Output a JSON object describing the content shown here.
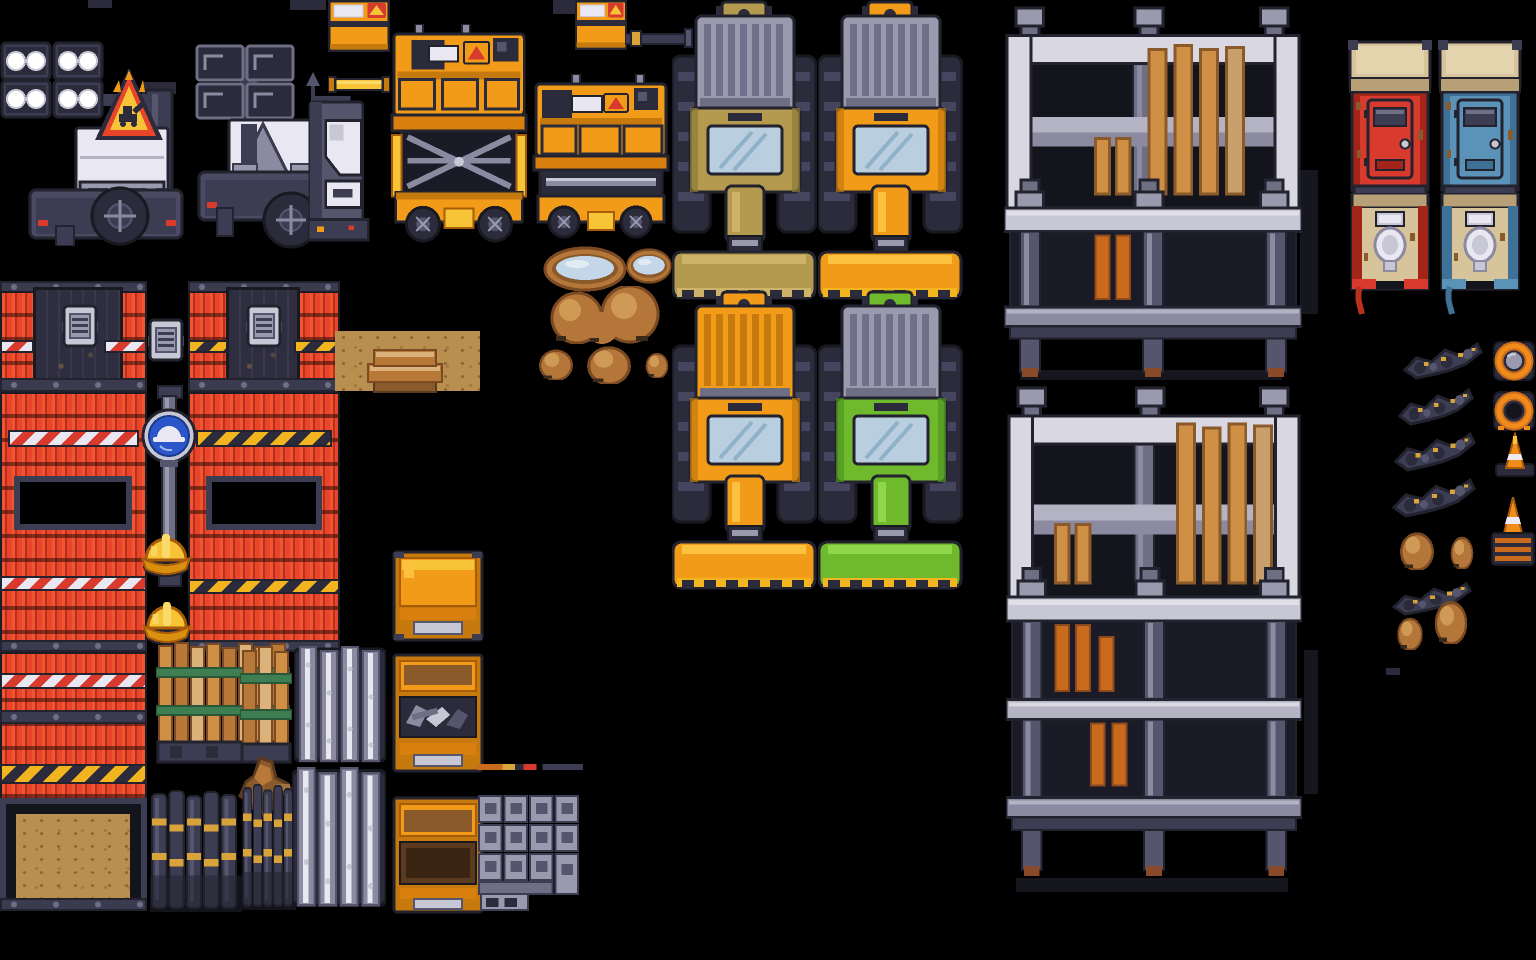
{
  "meta": {
    "asset_label": "construction-site pixel-art tileset spritesheet",
    "canvas": {
      "width": 1536,
      "height": 960,
      "background": "#000000"
    }
  },
  "palette": {
    "background": "#000000",
    "outline": "#23232f",
    "dark_navy": "#2b2b3b",
    "steel_dark": "#3c3c52",
    "steel_mid": "#55556e",
    "steel": "#6e6e85",
    "gray": "#9a9aae",
    "gray_light": "#c7c7d6",
    "white": "#e9e8f2",
    "scaffold_light": "#d8d7e2",
    "scaffold_mid": "#b4b3c4",
    "scaffold_shade": "#8b8aa0",
    "red_wall": "#e8452a",
    "red_wall_dark": "#b92f1f",
    "red_toilet": "#d93a2e",
    "blue_toilet": "#5b93b8",
    "blue_sign": "#2b56c9",
    "orange": "#f29b18",
    "orange_deep": "#c67a0d",
    "gold": "#f7c337",
    "gold_pale": "#fada6a",
    "hazard_yellow": "#f2b51f",
    "tan_vehicle": "#b39a4f",
    "green_vehicle": "#6fba2c",
    "wood": "#cf8f45",
    "wood_dark": "#8a5a2b",
    "dirt": "#b98f4f",
    "mound": "#b5763a",
    "water": "#c3d7e8",
    "cone_orange": "#f08c1c",
    "strap_green": "#3f7d52",
    "windshield": "#b9cede",
    "roof_tan": "#d8c49a"
  },
  "sprites": [
    {
      "name": "light-tower-lights-on",
      "type": "light-tower-on",
      "x": 0,
      "y": 38,
      "w": 185,
      "h": 208
    },
    {
      "name": "warning-triangle-sign",
      "type": "warning-triangle",
      "x": 93,
      "y": 66,
      "w": 72,
      "h": 80
    },
    {
      "name": "light-tower-lights-off",
      "type": "light-tower-off",
      "x": 195,
      "y": 40,
      "w": 152,
      "h": 210
    },
    {
      "name": "edge-stub",
      "type": "stub",
      "x": 88,
      "y": 0,
      "w": 24,
      "h": 8
    },
    {
      "name": "edge-stub",
      "type": "stub",
      "x": 290,
      "y": 0,
      "w": 36,
      "h": 10
    },
    {
      "name": "generator-box",
      "type": "generator",
      "x": 328,
      "y": 0,
      "w": 62,
      "h": 52
    },
    {
      "name": "gold-beam",
      "type": "beam-h",
      "x": 328,
      "y": 76,
      "w": 62,
      "h": 17
    },
    {
      "name": "white-compressor",
      "type": "compressor",
      "x": 308,
      "y": 96,
      "w": 62,
      "h": 150
    },
    {
      "name": "scissor-lift-extended",
      "type": "scissor-ext",
      "x": 388,
      "y": 24,
      "w": 144,
      "h": 220
    },
    {
      "name": "edge-stub",
      "type": "stub",
      "x": 553,
      "y": 0,
      "w": 34,
      "h": 14
    },
    {
      "name": "generator-box",
      "type": "generator",
      "x": 575,
      "y": 0,
      "w": 52,
      "h": 50
    },
    {
      "name": "exhaust-pipe-arm",
      "type": "pipe-arm",
      "x": 625,
      "y": 28,
      "w": 68,
      "h": 20
    },
    {
      "name": "scissor-lift-lowered",
      "type": "scissor-low",
      "x": 532,
      "y": 74,
      "w": 138,
      "h": 170
    },
    {
      "name": "bulldozer-tan",
      "type": "dozer",
      "x": 672,
      "y": 0,
      "w": 145,
      "h": 300,
      "colors": {
        "hitch": "#b39a4f",
        "grille": "#9a9aae",
        "grille-rib": "#70708a",
        "body": "#b39a4f",
        "body-dk": "#8f7a39",
        "body-lt": "#cdb469",
        "blade": "#b39a4f",
        "blade-lt": "#cdb469",
        "tooth": "#cdb469"
      }
    },
    {
      "name": "bulldozer-orange",
      "type": "dozer",
      "x": 818,
      "y": 0,
      "w": 145,
      "h": 300,
      "colors": {
        "hitch": "#f29b18",
        "grille": "#9a9aae",
        "grille-rib": "#70708a",
        "body": "#f29b18",
        "body-dk": "#c67a0d",
        "body-lt": "#fbc13f",
        "blade": "#f29b18",
        "blade-lt": "#fbc13f",
        "tooth": "#f2b51f"
      }
    },
    {
      "name": "bulldozer-orange-full",
      "type": "dozer",
      "x": 672,
      "y": 290,
      "w": 145,
      "h": 300,
      "colors": {
        "hitch": "#f29b18",
        "grille": "#f29b18",
        "grille-rib": "#c67a0d",
        "body": "#f29b18",
        "body-dk": "#c67a0d",
        "body-lt": "#fbc13f",
        "blade": "#f29b18",
        "blade-lt": "#fbc13f",
        "tooth": "#f2b51f"
      }
    },
    {
      "name": "bulldozer-green",
      "type": "dozer",
      "x": 818,
      "y": 290,
      "w": 145,
      "h": 300,
      "colors": {
        "hitch": "#6fba2c",
        "grille": "#9a9aae",
        "grille-rib": "#70708a",
        "body": "#6fba2c",
        "body-dk": "#4e9420",
        "body-lt": "#8fd64a",
        "blade": "#6fba2c",
        "blade-lt": "#8fd64a",
        "tooth": "#f2b51f"
      }
    },
    {
      "name": "scaffold-shadow",
      "type": "shadow",
      "x": 1300,
      "y": 170,
      "w": 18,
      "h": 144
    },
    {
      "name": "scaffold-shadow",
      "type": "shadow",
      "x": 1020,
      "y": 370,
      "w": 262,
      "h": 10
    },
    {
      "name": "scaffold-two-level",
      "type": "scaffold-a",
      "x": 1004,
      "y": 6,
      "w": 298,
      "h": 372
    },
    {
      "name": "scaffold-shadow",
      "type": "shadow",
      "x": 1304,
      "y": 650,
      "w": 14,
      "h": 144
    },
    {
      "name": "scaffold-shadow",
      "type": "shadow",
      "x": 1016,
      "y": 878,
      "w": 272,
      "h": 14
    },
    {
      "name": "scaffold-three-level",
      "type": "scaffold-b",
      "x": 1006,
      "y": 386,
      "w": 296,
      "h": 497
    },
    {
      "name": "porta-potty-red-closed",
      "type": "toilet-closed",
      "x": 1348,
      "y": 40,
      "w": 84,
      "h": 162,
      "colors": {
        "shell": "#d93a2e",
        "shell-dk": "#a32419"
      }
    },
    {
      "name": "porta-potty-blue-closed",
      "type": "toilet-closed",
      "x": 1438,
      "y": 40,
      "w": 84,
      "h": 162,
      "colors": {
        "shell": "#5b93b8",
        "shell-dk": "#3f7095"
      }
    },
    {
      "name": "porta-potty-red-open",
      "type": "toilet-open",
      "x": 1350,
      "y": 193,
      "w": 80,
      "h": 122,
      "colors": {
        "shell": "#d93a2e",
        "shell-dk": "#a32419",
        "hose": "#b92f1f"
      }
    },
    {
      "name": "porta-potty-blue-open",
      "type": "toilet-open",
      "x": 1440,
      "y": 193,
      "w": 80,
      "h": 122,
      "colors": {
        "shell": "#5b93b8",
        "shell-dk": "#3f7095",
        "hose": "#3f7095"
      }
    },
    {
      "name": "water-puddle-large",
      "type": "puddle",
      "x": 543,
      "y": 246,
      "w": 84,
      "h": 46
    },
    {
      "name": "water-puddle-small",
      "type": "puddle",
      "x": 626,
      "y": 248,
      "w": 46,
      "h": 36
    },
    {
      "name": "dirt-mound-pair",
      "type": "mound-pair",
      "x": 532,
      "y": 286,
      "w": 142,
      "h": 58
    },
    {
      "name": "dirt-mound",
      "type": "mound",
      "x": 532,
      "y": 346,
      "w": 48,
      "h": 34
    },
    {
      "name": "dirt-mound",
      "type": "mound",
      "x": 578,
      "y": 342,
      "w": 62,
      "h": 42
    },
    {
      "name": "dirt-mound",
      "type": "mound",
      "x": 641,
      "y": 350,
      "w": 32,
      "h": 28
    },
    {
      "name": "rubble-streak",
      "type": "debris",
      "x": 1403,
      "y": 340,
      "w": 80,
      "h": 40
    },
    {
      "name": "rubble-streak",
      "type": "debris",
      "x": 1398,
      "y": 386,
      "w": 76,
      "h": 40
    },
    {
      "name": "rubble-streak",
      "type": "debris",
      "x": 1394,
      "y": 430,
      "w": 82,
      "h": 42
    },
    {
      "name": "rubble-streak",
      "type": "debris",
      "x": 1392,
      "y": 476,
      "w": 84,
      "h": 42
    },
    {
      "name": "dirt-mound",
      "type": "mound",
      "x": 1393,
      "y": 528,
      "w": 48,
      "h": 42
    },
    {
      "name": "dirt-mound",
      "type": "mound",
      "x": 1446,
      "y": 533,
      "w": 32,
      "h": 36
    },
    {
      "name": "rubble-streak",
      "type": "debris",
      "x": 1392,
      "y": 580,
      "w": 80,
      "h": 36
    },
    {
      "name": "dirt-mound",
      "type": "mound",
      "x": 1428,
      "y": 596,
      "w": 46,
      "h": 48
    },
    {
      "name": "dirt-mound",
      "type": "mound",
      "x": 1392,
      "y": 614,
      "w": 36,
      "h": 36
    },
    {
      "name": "edge-stub",
      "type": "stub",
      "x": 1386,
      "y": 668,
      "w": 14,
      "h": 7
    },
    {
      "name": "cone-top-view-filled",
      "type": "cone-top-a",
      "x": 1492,
      "y": 336,
      "w": 44,
      "h": 48
    },
    {
      "name": "cone-top-view-hole",
      "type": "cone-top-b",
      "x": 1492,
      "y": 386,
      "w": 44,
      "h": 48
    },
    {
      "name": "traffic-cone",
      "type": "cone-side",
      "x": 1494,
      "y": 432,
      "w": 42,
      "h": 46
    },
    {
      "name": "traffic-cone-on-stack",
      "type": "cone-stack",
      "x": 1490,
      "y": 497,
      "w": 46,
      "h": 70
    },
    {
      "name": "roof-beam",
      "type": "dark-beam",
      "x": 0,
      "y": 281,
      "w": 147,
      "h": 12
    },
    {
      "name": "roof-beam",
      "type": "dark-beam",
      "x": 188,
      "y": 281,
      "w": 152,
      "h": 12
    },
    {
      "name": "red-wall",
      "type": "red-wall",
      "x": 0,
      "y": 291,
      "w": 147,
      "h": 89
    },
    {
      "name": "red-wall",
      "type": "red-wall",
      "x": 188,
      "y": 291,
      "w": 152,
      "h": 89
    },
    {
      "name": "doorway",
      "type": "dark-door",
      "x": 33,
      "y": 287,
      "w": 90,
      "h": 99
    },
    {
      "name": "doorway",
      "type": "dark-door",
      "x": 226,
      "y": 287,
      "w": 74,
      "h": 99
    },
    {
      "name": "hazard-stripe-red-white",
      "type": "stripe-rw",
      "x": 0,
      "y": 340,
      "w": 34,
      "h": 13
    },
    {
      "name": "hazard-stripe-red-white",
      "type": "stripe-rw",
      "x": 104,
      "y": 340,
      "w": 43,
      "h": 13
    },
    {
      "name": "hazard-stripe-yellow-black",
      "type": "stripe-yb",
      "x": 188,
      "y": 340,
      "w": 40,
      "h": 13
    },
    {
      "name": "hazard-stripe-yellow-black",
      "type": "stripe-yb",
      "x": 294,
      "y": 340,
      "w": 46,
      "h": 13
    },
    {
      "name": "wall-vent",
      "type": "vent",
      "x": 62,
      "y": 304,
      "w": 36,
      "h": 44
    },
    {
      "name": "wall-vent",
      "type": "vent",
      "x": 246,
      "y": 304,
      "w": 36,
      "h": 44
    },
    {
      "name": "wall-vent",
      "type": "vent",
      "x": 148,
      "y": 318,
      "w": 36,
      "h": 44
    },
    {
      "name": "roof-beam",
      "type": "dark-beam",
      "x": 0,
      "y": 378,
      "w": 147,
      "h": 14
    },
    {
      "name": "roof-beam",
      "type": "dark-beam",
      "x": 188,
      "y": 378,
      "w": 150,
      "h": 14
    },
    {
      "name": "red-wall",
      "type": "red-wall",
      "x": 0,
      "y": 392,
      "w": 147,
      "h": 250
    },
    {
      "name": "red-wall",
      "type": "red-wall",
      "x": 188,
      "y": 392,
      "w": 152,
      "h": 250
    },
    {
      "name": "hazard-stripe-red-white",
      "type": "stripe-rw",
      "x": 8,
      "y": 430,
      "w": 131,
      "h": 17
    },
    {
      "name": "hazard-stripe-yellow-black",
      "type": "stripe-yb",
      "x": 196,
      "y": 430,
      "w": 136,
      "h": 17
    },
    {
      "name": "window-opening",
      "type": "black-opening",
      "x": 14,
      "y": 476,
      "w": 118,
      "h": 54
    },
    {
      "name": "window-opening",
      "type": "black-opening",
      "x": 206,
      "y": 476,
      "w": 116,
      "h": 54
    },
    {
      "name": "hazard-stripe-red-white",
      "type": "stripe-rw",
      "x": 0,
      "y": 576,
      "w": 147,
      "h": 15
    },
    {
      "name": "hazard-stripe-yellow-black",
      "type": "stripe-yb",
      "x": 188,
      "y": 579,
      "w": 152,
      "h": 15
    },
    {
      "name": "roof-beam",
      "type": "dark-beam",
      "x": 0,
      "y": 640,
      "w": 147,
      "h": 12
    },
    {
      "name": "roof-beam",
      "type": "dark-beam",
      "x": 188,
      "y": 640,
      "w": 152,
      "h": 12
    },
    {
      "name": "dirt-patch",
      "type": "dirt",
      "x": 335,
      "y": 331,
      "w": 145,
      "h": 60
    },
    {
      "name": "wooden-steps",
      "type": "steps",
      "x": 366,
      "y": 346,
      "w": 78,
      "h": 48
    },
    {
      "name": "red-wall",
      "type": "red-wall",
      "x": 0,
      "y": 652,
      "w": 147,
      "h": 148
    },
    {
      "name": "hazard-stripe-red-white",
      "type": "stripe-rw",
      "x": 0,
      "y": 673,
      "w": 147,
      "h": 16
    },
    {
      "name": "roof-beam",
      "type": "dark-beam",
      "x": 0,
      "y": 710,
      "w": 147,
      "h": 14
    },
    {
      "name": "hazard-stripe-yellow-black",
      "type": "stripe-yb",
      "x": 0,
      "y": 764,
      "w": 147,
      "h": 20
    },
    {
      "name": "garage-opening",
      "type": "garage",
      "x": 0,
      "y": 798,
      "w": 147,
      "h": 112
    },
    {
      "name": "garage-dirt-floor",
      "type": "dirt",
      "x": 16,
      "y": 814,
      "w": 114,
      "h": 90
    },
    {
      "name": "roof-beam",
      "type": "dark-beam",
      "x": 0,
      "y": 898,
      "w": 147,
      "h": 13
    },
    {
      "name": "hard-hat-sign-pole",
      "type": "pole-sign",
      "x": 140,
      "y": 384,
      "w": 56,
      "h": 205
    },
    {
      "name": "hard-hat",
      "type": "hard-hat",
      "x": 140,
      "y": 520,
      "w": 52,
      "h": 58
    },
    {
      "name": "hard-hat",
      "type": "hard-hat",
      "x": 142,
      "y": 588,
      "w": 50,
      "h": 58
    },
    {
      "name": "plank-bundle-wide",
      "type": "planks-wide",
      "x": 156,
      "y": 642,
      "w": 134,
      "h": 122
    },
    {
      "name": "plank-bundle-narrow",
      "type": "planks-narrow",
      "x": 240,
      "y": 646,
      "w": 52,
      "h": 118
    },
    {
      "name": "broken-wood-stump",
      "type": "wood-stump",
      "x": 236,
      "y": 756,
      "w": 60,
      "h": 64
    },
    {
      "name": "rebar-bundle",
      "type": "rebar",
      "x": 150,
      "y": 790,
      "w": 92,
      "h": 122
    },
    {
      "name": "rebar-bundle",
      "type": "rebar",
      "x": 242,
      "y": 784,
      "w": 54,
      "h": 126
    },
    {
      "name": "steel-pipe-bundle",
      "type": "pipes",
      "x": 294,
      "y": 645,
      "w": 92,
      "h": 120
    },
    {
      "name": "steel-pipe-bundle",
      "type": "pipes",
      "x": 292,
      "y": 766,
      "w": 94,
      "h": 144
    },
    {
      "name": "crate-closed",
      "type": "crate-closed",
      "x": 392,
      "y": 550,
      "w": 92,
      "h": 92
    },
    {
      "name": "crate-open-tools",
      "type": "crate-tools",
      "x": 392,
      "y": 653,
      "w": 92,
      "h": 120
    },
    {
      "name": "crate-open-empty",
      "type": "crate-empty",
      "x": 392,
      "y": 796,
      "w": 92,
      "h": 118
    },
    {
      "name": "thin-material-strips",
      "type": "lines",
      "x": 477,
      "y": 764,
      "w": 106,
      "h": 6
    },
    {
      "name": "cinder-block-stack",
      "type": "blocks",
      "x": 477,
      "y": 794,
      "w": 104,
      "h": 118
    }
  ]
}
